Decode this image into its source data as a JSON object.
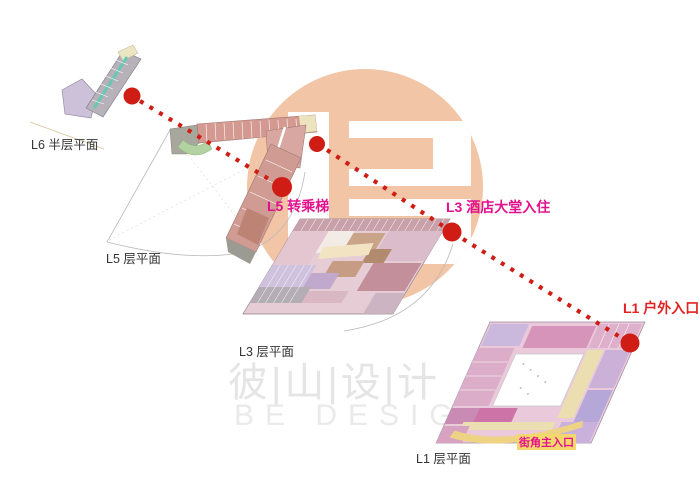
{
  "page": {
    "width": 700,
    "height": 503,
    "background": "#ffffff"
  },
  "diagram": {
    "type": "architectural-circulation-axonometric",
    "floors": [
      {
        "id": "L6",
        "plan_label": "L6 半层平面"
      },
      {
        "id": "L5",
        "plan_label": "L5 层平面",
        "annotation": "L5 转乘梯"
      },
      {
        "id": "L3",
        "plan_label": "L3 层平面",
        "annotation": "L3 酒店大堂入住"
      },
      {
        "id": "L1",
        "plan_label": "L1 层平面",
        "annotation": "L1 户外入口",
        "corner_entrance_label": "街角主入口"
      }
    ],
    "path": {
      "style": "dotted-line-with-nodes",
      "color": "#cf1d15",
      "nodes": [
        {
          "floor": "L6",
          "x": 132,
          "y": 96
        },
        {
          "floor": "L5",
          "x": 282,
          "y": 187,
          "label": "L5 转乘梯"
        },
        {
          "floor": "L5-exit",
          "x": 317,
          "y": 144
        },
        {
          "floor": "L3",
          "x": 452,
          "y": 232,
          "label": "L3 酒店大堂入住"
        },
        {
          "floor": "L1",
          "x": 630,
          "y": 343,
          "label": "L1 户外入口"
        }
      ]
    }
  },
  "watermark": {
    "cn": "彼|山|设|计",
    "en": "BE DESIGN",
    "logo_color": "#f2c5a6"
  },
  "colors": {
    "accent_red": "#cf1d15",
    "magenta": "#e3118c",
    "entrance_red": "#e32222",
    "label_black": "#333333",
    "highlight_yellow": "#f5d86d",
    "logo_peach": "#f2c5a6"
  }
}
